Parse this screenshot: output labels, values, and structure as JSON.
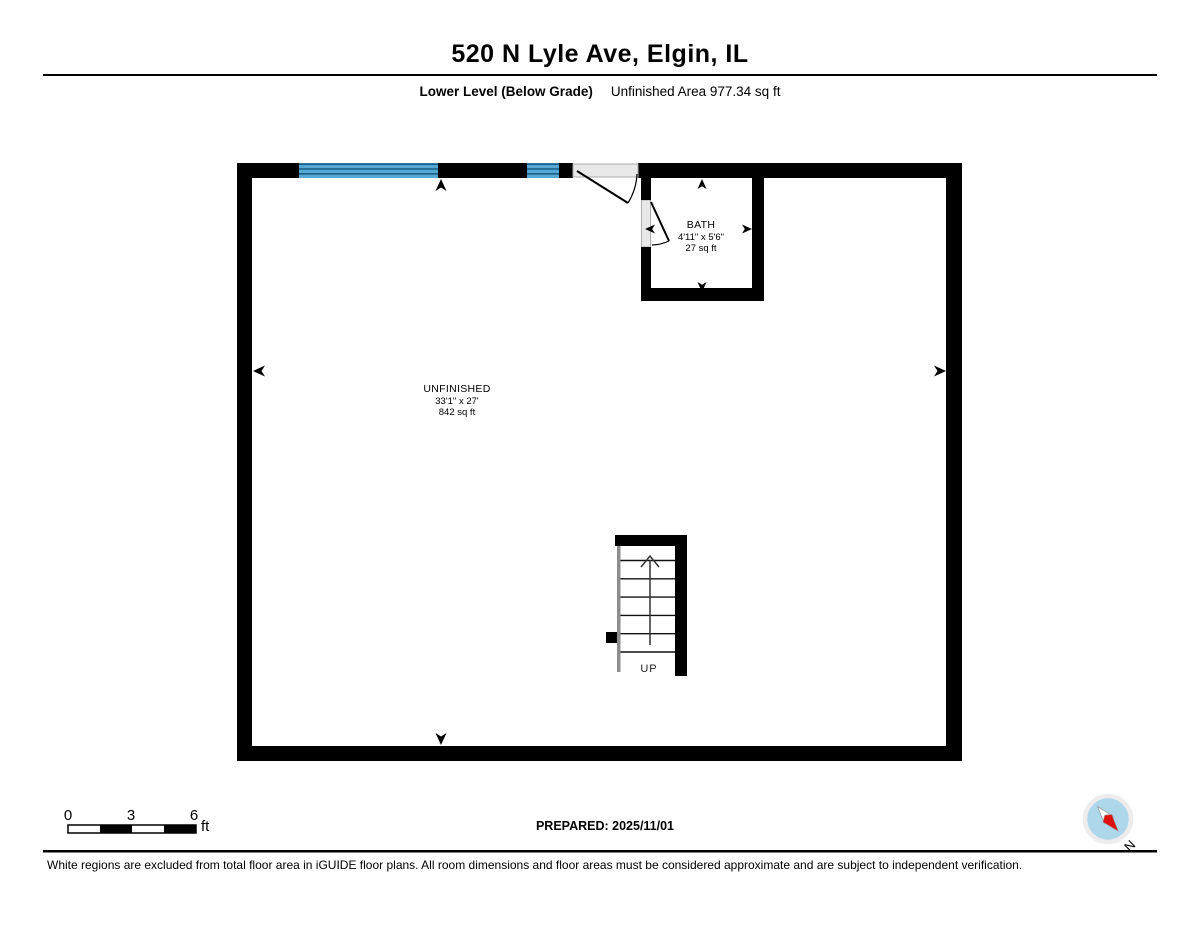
{
  "header": {
    "title": "520 N Lyle Ave, Elgin, IL",
    "level_label": "Lower Level (Below Grade)",
    "area_label": "Unfinished Area 977.34 sq ft"
  },
  "rooms": {
    "bath": {
      "name": "BATH",
      "dimensions": "4'11\" x 5'6\"",
      "area": "27 sq ft"
    },
    "unfinished": {
      "name": "UNFINISHED",
      "dimensions": "33'1\" x 27'",
      "area": "842 sq ft"
    }
  },
  "stairs": {
    "direction_label": "UP"
  },
  "scale_bar": {
    "tick_0": "0",
    "tick_3": "3",
    "tick_6": "6",
    "unit": "ft"
  },
  "footer": {
    "prepared": "PREPARED: 2025/11/01",
    "disclaimer": "White regions are excluded from total floor area in iGUIDE floor plans. All room dimensions and floor areas must be considered approximate and are subject to independent verification.",
    "compass_label": "N"
  },
  "colors": {
    "wall": "#000000",
    "window_blue": "#55A8D4",
    "window_line": "#1C5F86",
    "door_opening_gray": "#E8E8E8",
    "compass_fill": "#AFD7EC",
    "compass_red": "#DD1111"
  }
}
